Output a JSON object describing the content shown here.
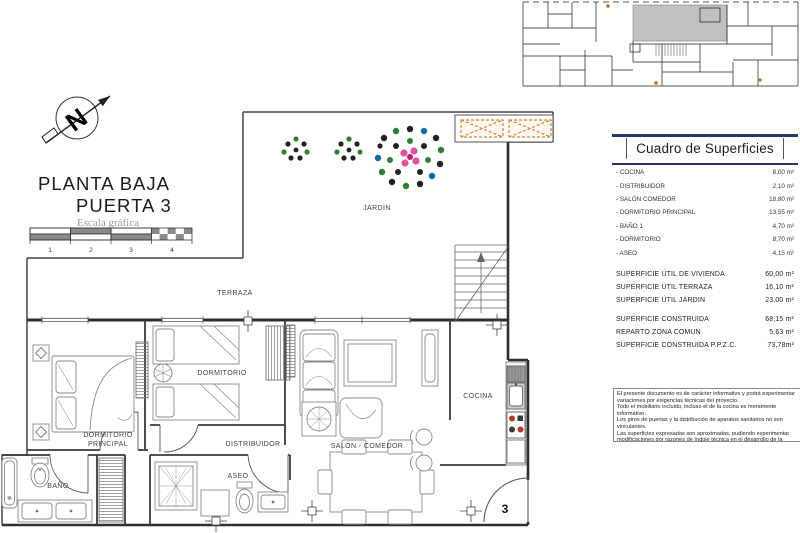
{
  "title_block": {
    "line1": "PLANTA BAJA",
    "line2": "PUERTA 3",
    "scale_caption": "Escala gráfica",
    "scale_ticks": [
      "1",
      "2",
      "3",
      "4"
    ]
  },
  "plan": {
    "rooms": {
      "jardin": "JARDIN",
      "terraza": "TERRAZA",
      "dormitorio": "DORMITORIO",
      "dormitorio_principal_l1": "DORMITORIO",
      "dormitorio_principal_l2": "PRINCIPAL",
      "distribuidor": "DISTRIBUIDOR",
      "salon_comedor": "SALÓN - COMEDOR",
      "aseo": "ASEO",
      "bano": "BAÑO",
      "cocina": "COCINA"
    },
    "door_number": "3"
  },
  "surfaces": {
    "title": "Cuadro de Superficies",
    "rooms": [
      {
        "label": "- COCINA",
        "value": "8,00 m²"
      },
      {
        "label": "- DISTRIBUIDOR",
        "value": "2,10 m²"
      },
      {
        "label": "- SALÓN COMEDOR",
        "value": "18,80 m²"
      },
      {
        "label": "- DORMITORIO PRINCIPAL",
        "value": "13,55 m²"
      },
      {
        "label": "- BAÑO 1",
        "value": "4,70 m²"
      },
      {
        "label": "- DORMITORIO",
        "value": "8,70 m²"
      },
      {
        "label": "- ASEO",
        "value": "4,15 m²"
      }
    ],
    "utiles": [
      {
        "label": "SUPERFICIE ÚTIL DE VIVIENDA",
        "value": "60,00 m²"
      },
      {
        "label": "SUPERFICIE ÚTIL TERRAZA",
        "value": "16,10 m²"
      },
      {
        "label": "SUPERFICIE ÚTIL JARDIN",
        "value": "23,00 m²"
      }
    ],
    "construidas": [
      {
        "label": "SUPERFICIE CONSTRUIDA",
        "value": "68,15 m²"
      },
      {
        "label": "REPARTO ZONA COMUN",
        "value": "5,63 m²"
      },
      {
        "label": "SUPERFICIE CONSTRUIDA P.P.Z.C.",
        "value": "73,78m²"
      }
    ]
  },
  "disclaimer": {
    "lines": [
      "El presente documento es de carácter informativo y podrá experimentar variaciones por exigencias técnicas del proyecto.",
      "Todo el mobiliario incluido, incluso el de la cocina es meramente informativo.",
      "Los giros de puertas y la distribución de aparatos sanitarios no son vinculantes.",
      "Las superficies expresadas son aproximadas, pudiendo experimentar modificaciones por razones de índole técnica en el desarrollo de la ejecución de las obras.",
      "La superficie útil y construida se calcula conforme al Reglamento de Información al consumidor en la compraventa y arrendamiento de viviendas en Andalucía. Decreto 218/2005."
    ]
  },
  "colors": {
    "rule_navy": "#28356e",
    "pergola_orange": "#c8882d",
    "site_plan_gray": "#c0c0c0",
    "flower_pink": "#e052a0",
    "plant_green": "#2f7d32",
    "hob_red": "#b03a2e"
  }
}
